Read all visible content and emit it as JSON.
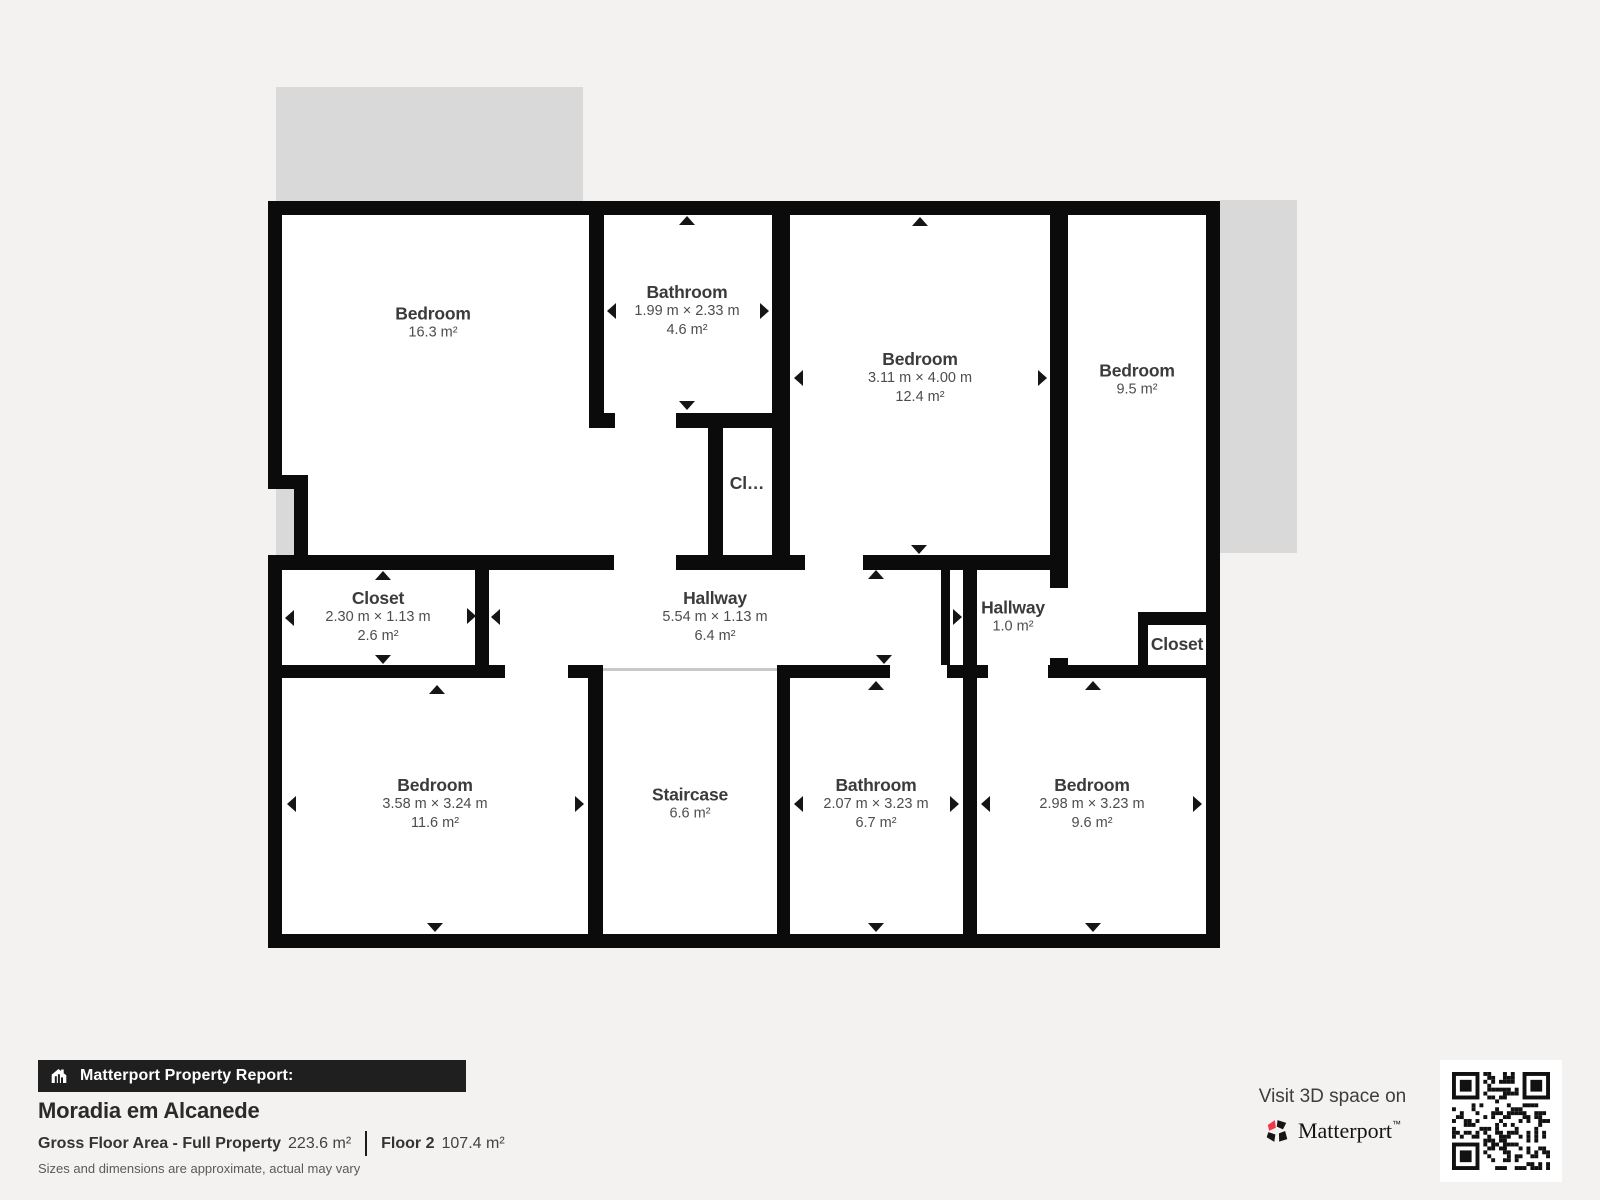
{
  "plan": {
    "rooms": [
      {
        "name": "Bedroom",
        "area": "16.3 m²"
      },
      {
        "name": "Bathroom",
        "dims": "1.99 m × 2.33 m",
        "area": "4.6 m²"
      },
      {
        "name": "Bedroom",
        "dims": "3.11 m × 4.00 m",
        "area": "12.4 m²"
      },
      {
        "name": "Bedroom",
        "area": "9.5 m²"
      },
      {
        "name": "Cl…"
      },
      {
        "name": "Closet",
        "dims": "2.30 m × 1.13 m",
        "area": "2.6 m²"
      },
      {
        "name": "Hallway",
        "dims": "5.54 m × 1.13 m",
        "area": "6.4 m²"
      },
      {
        "name": "Hallway",
        "area": "1.0 m²"
      },
      {
        "name": "Closet"
      },
      {
        "name": "Bedroom",
        "dims": "3.58 m × 3.24 m",
        "area": "11.6 m²"
      },
      {
        "name": "Staircase",
        "area": "6.6 m²"
      },
      {
        "name": "Bathroom",
        "dims": "2.07 m × 3.23 m",
        "area": "6.7 m²"
      },
      {
        "name": "Bedroom",
        "dims": "2.98 m × 3.23 m",
        "area": "9.6 m²"
      }
    ],
    "colors": {
      "wall": "#0b0b0b",
      "floor": "#ffffff",
      "underfloor_gray": "#d9d9d9",
      "background": "#f4f2f0",
      "label_text": "#3b3b3b"
    }
  },
  "footer": {
    "report_bar": {
      "icon": "house-bars-icon",
      "label": "Matterport Property Report:"
    },
    "title": "Moradia em Alcanede",
    "stats": {
      "gross_label": "Gross Floor Area - Full Property",
      "gross_value": "223.6 m²",
      "floor_label": "Floor 2",
      "floor_value": "107.4 m²"
    },
    "disclaimer": "Sizes and dimensions are approximate, actual may vary"
  },
  "cta": {
    "visit_line": "Visit 3D space on",
    "brand": "Matterport",
    "brand_mark": "™",
    "logo_icon": "matterport-pinwheel-logo",
    "qr_icon": "qr-code",
    "brand_pink": "#f4364c"
  }
}
